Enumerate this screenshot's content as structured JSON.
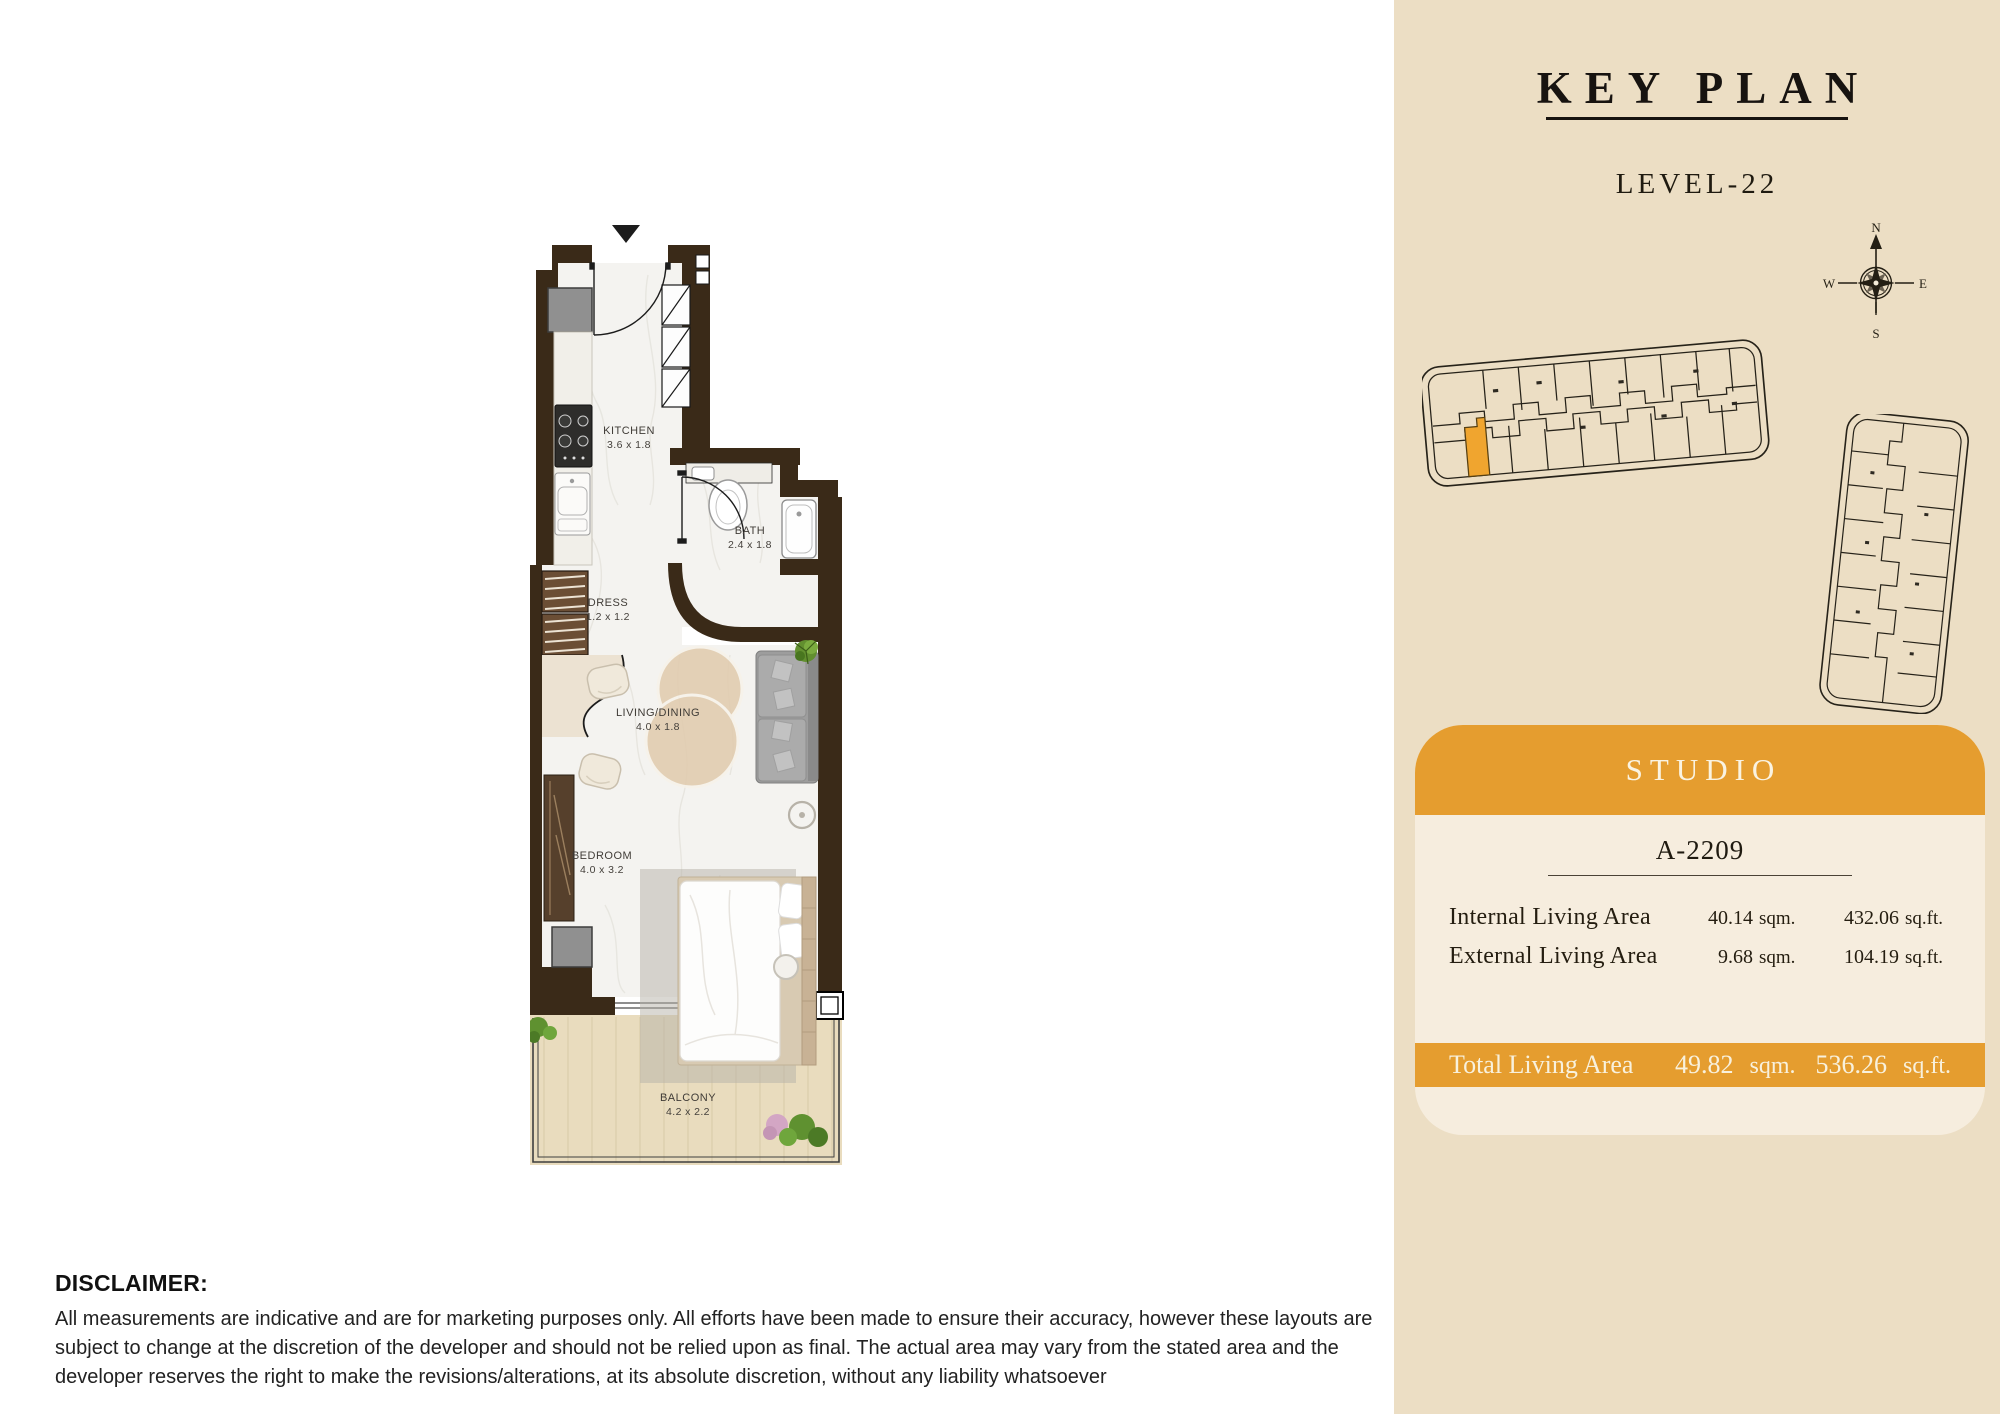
{
  "floor_plan": {
    "rooms": [
      {
        "name": "KITCHEN",
        "dims": "3.6 x 1.8"
      },
      {
        "name": "BATH",
        "dims": "2.4 x 1.8"
      },
      {
        "name": "DRESS",
        "dims": "1.2 x 1.2"
      },
      {
        "name": "LIVING/DINING",
        "dims": "4.0 x 1.8"
      },
      {
        "name": "BEDROOM",
        "dims": "4.0 x 3.2"
      },
      {
        "name": "BALCONY",
        "dims": "4.2 x 2.2"
      }
    ]
  },
  "key_plan": {
    "title": "KEY PLAN",
    "level": "LEVEL-22",
    "compass": {
      "north": "N",
      "east": "E",
      "south": "S",
      "west": "W"
    }
  },
  "unit_card": {
    "type_label": "STUDIO",
    "unit_number": "A-2209",
    "areas": [
      {
        "label": "Internal Living Area",
        "sqm": "40.14",
        "sqm_unit": "sqm.",
        "sqft": "432.06",
        "sqft_unit": "sq.ft."
      },
      {
        "label": "External Living Area",
        "sqm": "9.68",
        "sqm_unit": "sqm.",
        "sqft": "104.19",
        "sqft_unit": "sq.ft."
      }
    ],
    "total": {
      "label": "Total Living Area",
      "sqm": "49.82",
      "sqm_unit": "sqm.",
      "sqft": "536.26",
      "sqft_unit": "sq.ft."
    }
  },
  "disclaimer": {
    "title": "DISCLAIMER:",
    "body": "All measurements are indicative and are for marketing purposes only. All efforts have been made to ensure their accuracy, however these layouts are subject to change at the discretion of the developer and should not be relied upon as final. The actual area may vary from the stated area and the developer reserves the right to make the revisions/alterations, at its absolute discretion, without any liability whatsoever"
  },
  "colors": {
    "accent_orange": "#E59D2F",
    "panel_background": "#ECDEC4",
    "card_background": "#F6EDDE",
    "wall_brown": "#3A2A18",
    "highlighted_unit": "#F0A52F"
  }
}
